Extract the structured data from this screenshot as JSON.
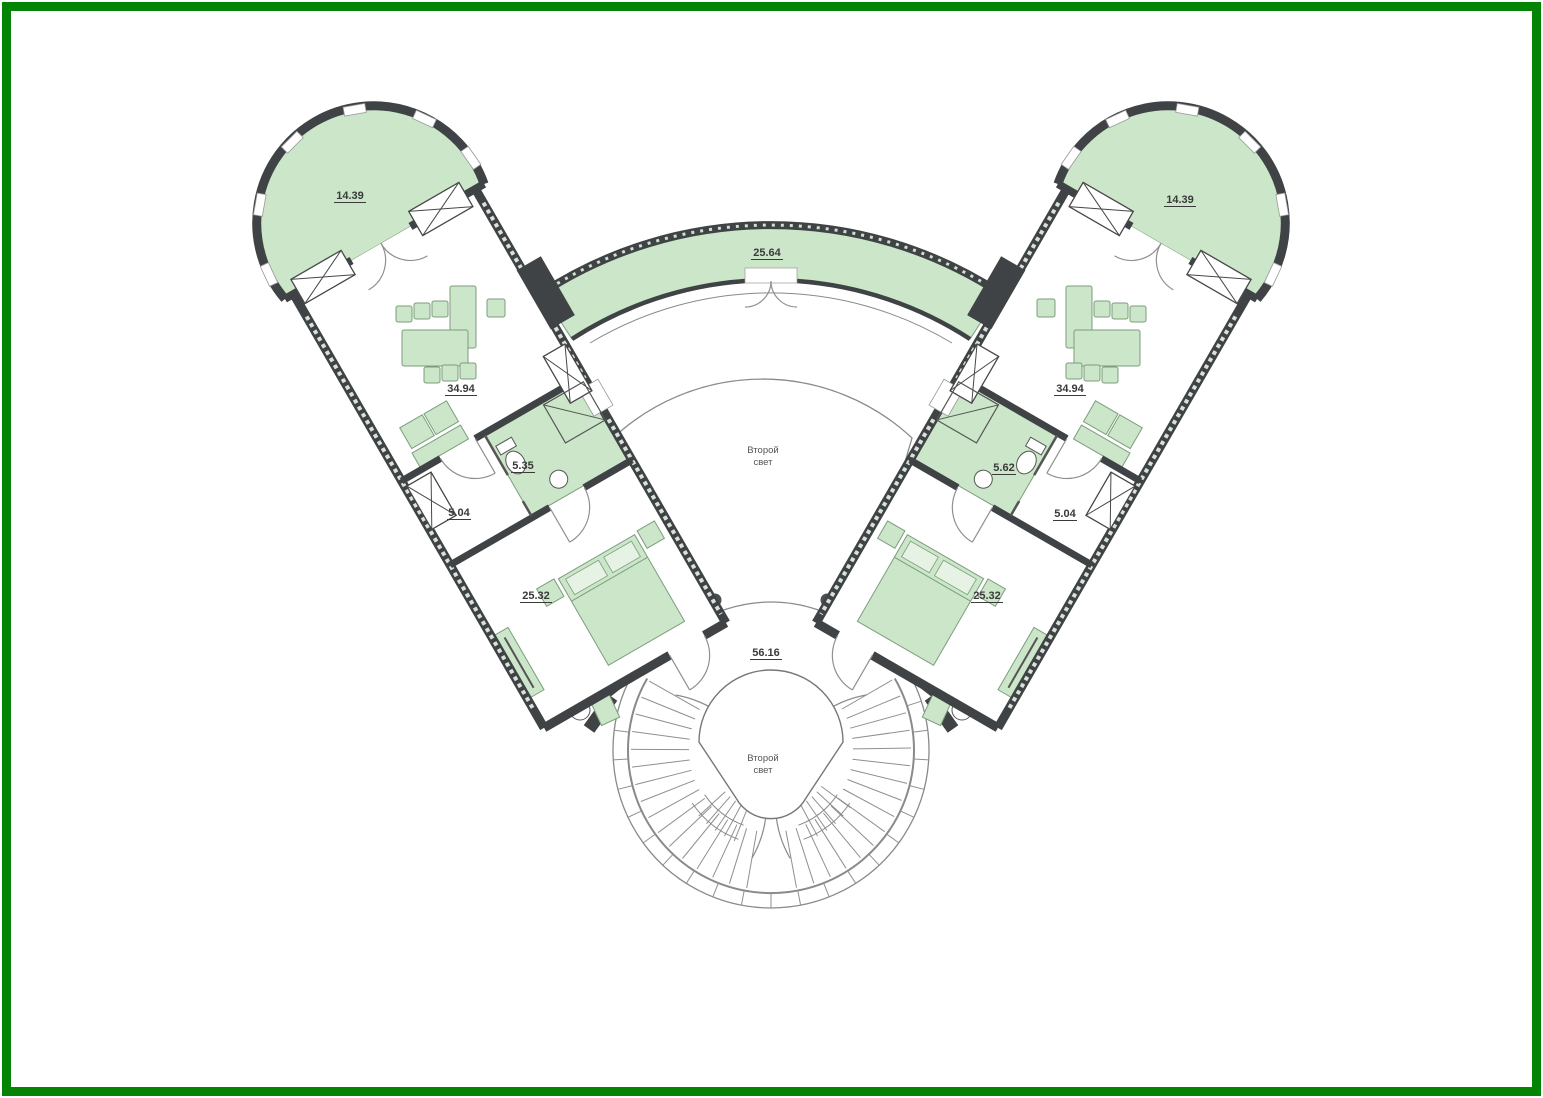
{
  "frame": {
    "border_color": "#048404",
    "background": "#ffffff"
  },
  "plan": {
    "colors": {
      "room_fill": "#cbe6c9",
      "wall": "#3f4345",
      "line": "#8a8a8a",
      "label": "#3a3a3a"
    },
    "areas": {
      "tower_left": "14.39",
      "tower_right": "14.39",
      "balcony": "25.64",
      "living_left": "34.94",
      "living_right": "34.94",
      "bath_left": "5.35",
      "bath_right": "5.62",
      "hall_left": "5.04",
      "hall_right": "5.04",
      "bedroom_left": "25.32",
      "bedroom_right": "25.32",
      "stair_landing": "56.16"
    },
    "texts": {
      "atrium_line1": "Второй",
      "atrium_line2": "свет",
      "void_line1": "Второй",
      "void_line2": "свет"
    }
  }
}
